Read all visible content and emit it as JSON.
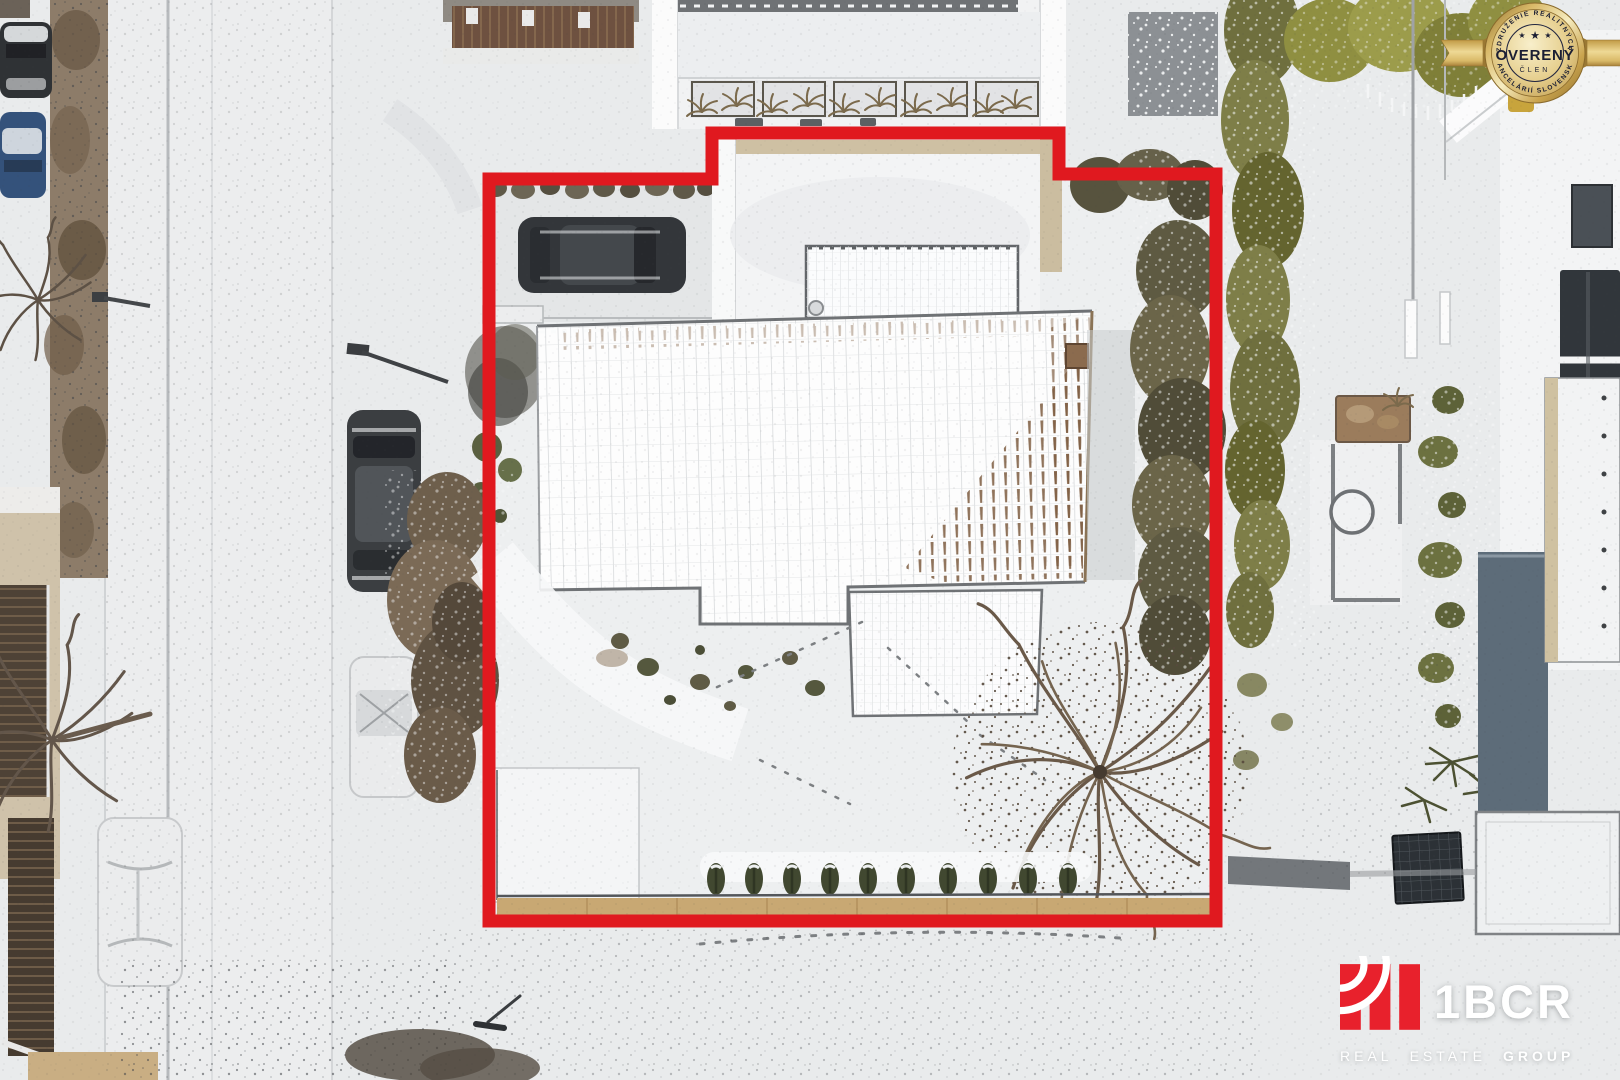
{
  "badge": {
    "arc_top": "ZDRUŽENIE REALITNÝCH",
    "arc_bottom": "KANCELÁRIÍ SLOVENSKA",
    "title": "OVERENÝ",
    "subtitle": "ČLEN",
    "stars": [
      "★",
      "★",
      "★"
    ]
  },
  "logo": {
    "name": "1BCR",
    "words": [
      "REAL",
      "ESTATE",
      "GROUP"
    ]
  },
  "colors": {
    "boundary_red": "#e0191f",
    "badge_gold": "#d9b968",
    "badge_text": "#1b1e33",
    "logo_red": "#e8212c",
    "logo_text": "#ffffff"
  }
}
